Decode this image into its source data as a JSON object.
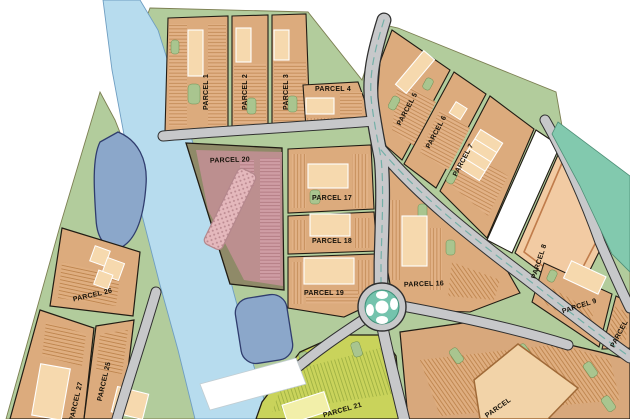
{
  "map": {
    "type": "development-site-plan",
    "parcels": [
      {
        "id": "parcel-1",
        "label": "PARCEL 1"
      },
      {
        "id": "parcel-2",
        "label": "PARCEL 2"
      },
      {
        "id": "parcel-3",
        "label": "PARCEL 3"
      },
      {
        "id": "parcel-4",
        "label": "PARCEL 4"
      },
      {
        "id": "parcel-5",
        "label": "PARCEL 5"
      },
      {
        "id": "parcel-6",
        "label": "PARCEL 6"
      },
      {
        "id": "parcel-7",
        "label": "PARCEL 7"
      },
      {
        "id": "parcel-8",
        "label": "PARCEL 8"
      },
      {
        "id": "parcel-9",
        "label": "PARCEL 9"
      },
      {
        "id": "parcel-16",
        "label": "PARCEL 16"
      },
      {
        "id": "parcel-17",
        "label": "PARCEL 17"
      },
      {
        "id": "parcel-18",
        "label": "PARCEL 18"
      },
      {
        "id": "parcel-19",
        "label": "PARCEL 19"
      },
      {
        "id": "parcel-20",
        "label": "PARCEL 20"
      },
      {
        "id": "parcel-21",
        "label": "PARCEL 21"
      },
      {
        "id": "parcel-25",
        "label": "PARCEL 25"
      },
      {
        "id": "parcel-26",
        "label": "PARCEL 26"
      },
      {
        "id": "parcel-27",
        "label": "PARCEL 27"
      },
      {
        "id": "parcel-edge-right",
        "label": "PARCEL"
      },
      {
        "id": "parcel-edge-bottom",
        "label": "PARCEL"
      }
    ],
    "features": {
      "river": "river",
      "ponds": "retention-ponds",
      "roundabout": "traffic-circle",
      "bridge": "bridge-crossing"
    },
    "colors": {
      "river": "#b7dcee",
      "pond": "#8ba7ca",
      "landscape_green": "#b2cc9c",
      "road_gray": "#c7c8ca",
      "parcel_tan": "#dcab7d",
      "parking_tan": "#e2b287",
      "building_tan": "#f6d9ae",
      "residential_pink": "#c18f94",
      "commercial_lime": "#c9d35b",
      "roundabout_teal": "#74c3ad",
      "buffer_teal": "#82c9ae",
      "vacant_white": "#ffffff"
    }
  }
}
